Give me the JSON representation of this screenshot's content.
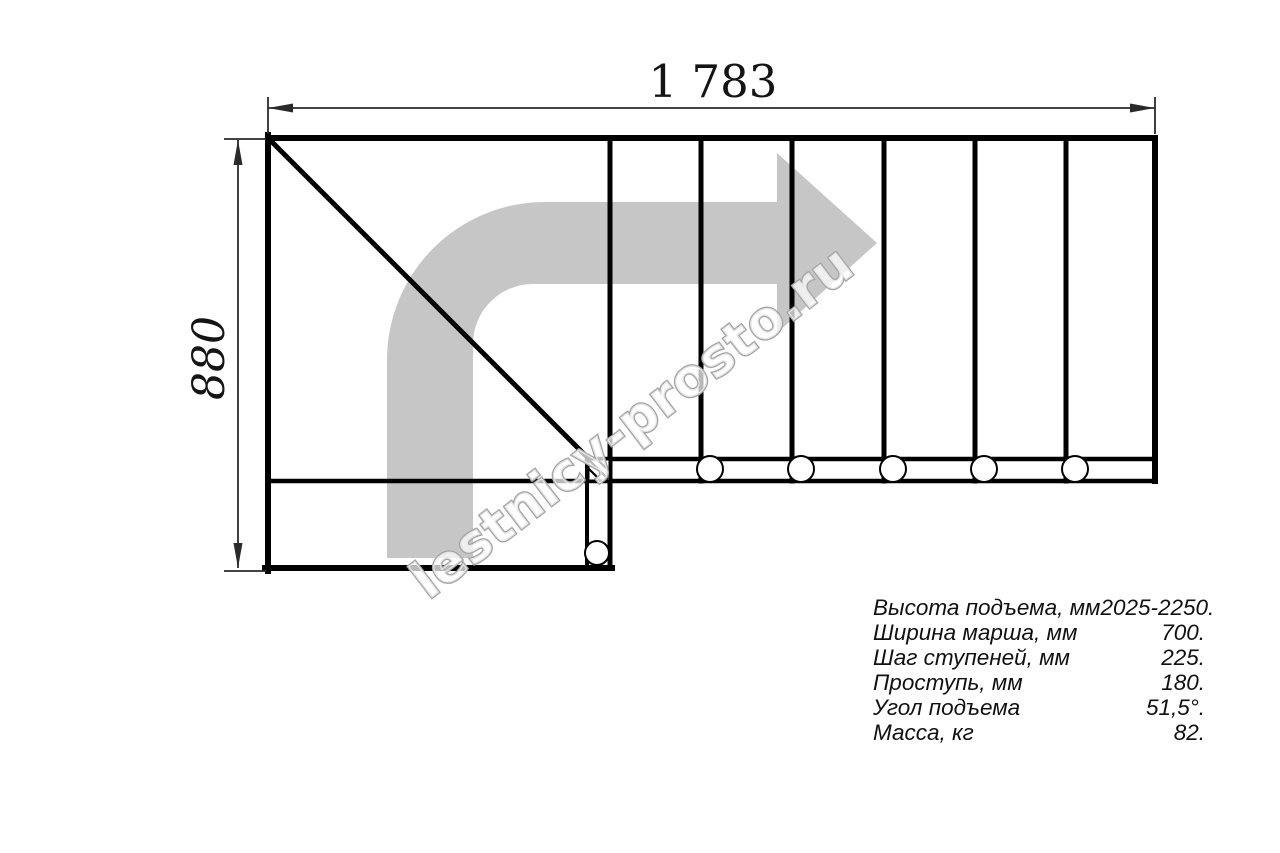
{
  "watermark": {
    "text": "lestnicy-prosto.ru"
  },
  "dimensions": {
    "width_label": "1 783",
    "height_label": "880"
  },
  "specs": {
    "rows": [
      {
        "label": "Высота подъема, мм",
        "value": "2025-2250."
      },
      {
        "label": "Ширина марша, мм",
        "value": "700."
      },
      {
        "label": "Шаг ступеней, мм",
        "value": "225."
      },
      {
        "label": "Проступь, мм",
        "value": "180."
      },
      {
        "label": "Угол подъема",
        "value": "51,5°."
      },
      {
        "label": "Масса, кг",
        "value": "82."
      }
    ]
  },
  "colors": {
    "line": "#000000",
    "dim_line": "#2a2a2a",
    "arrow_fill": "#c6c6c6",
    "watermark_stroke": "#a5a5a5"
  }
}
